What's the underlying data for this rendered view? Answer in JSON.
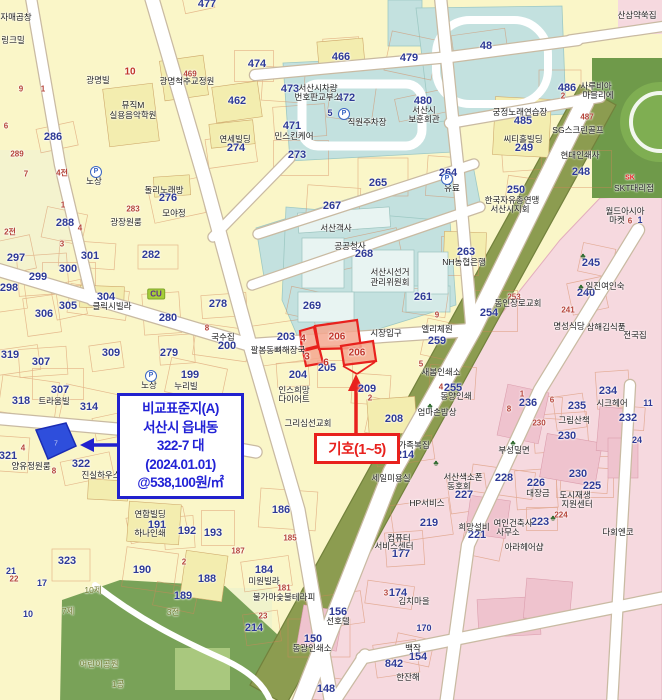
{
  "annotation": {
    "lines": [
      "비교표준지(A)",
      "서산시 읍내동",
      "322-7  대",
      "(2024.01.01)",
      "@538,100원/㎡"
    ],
    "border_color": "#2121CE",
    "text_color": "#2222D6"
  },
  "marker": {
    "label": "기호(1~5)",
    "color": "#E8211D"
  },
  "highlight": {
    "blue_parcel_no": "7",
    "blue_fill": "#2E4EDC",
    "red_fill": "#F5A78F",
    "red_stroke": "#E8211D"
  },
  "colors": {
    "base": "#FAF6C8",
    "civic": "#C3E1DF",
    "commercial": "#F6D9DF",
    "greenbelt": "#8C9C50",
    "park": "#79A258",
    "road": "#FFFFFF"
  },
  "labels": [
    {
      "t": "477",
      "x": 207,
      "y": 4,
      "c": "pn"
    },
    {
      "t": "462",
      "x": 237,
      "y": 101,
      "c": "pn"
    },
    {
      "t": "466",
      "x": 341,
      "y": 57,
      "c": "pn"
    },
    {
      "t": "474",
      "x": 257,
      "y": 64,
      "c": "pn"
    },
    {
      "t": "473",
      "x": 290,
      "y": 89,
      "c": "pn"
    },
    {
      "t": "472",
      "x": 346,
      "y": 98,
      "c": "pn"
    },
    {
      "t": "479",
      "x": 409,
      "y": 58,
      "c": "pn"
    },
    {
      "t": "480",
      "x": 423,
      "y": 101,
      "c": "pn"
    },
    {
      "t": "48",
      "x": 486,
      "y": 46,
      "c": "pn"
    },
    {
      "t": "10",
      "x": 130,
      "y": 72,
      "c": "rsb"
    },
    {
      "t": "9",
      "x": 21,
      "y": 89,
      "c": "rs"
    },
    {
      "t": "1",
      "x": 43,
      "y": 89,
      "c": "rs"
    },
    {
      "t": "6",
      "x": 6,
      "y": 126,
      "c": "rs"
    },
    {
      "t": "289",
      "x": 17,
      "y": 154,
      "c": "rs"
    },
    {
      "t": "286",
      "x": 53,
      "y": 137,
      "c": "pn"
    },
    {
      "t": "광명빌",
      "x": 98,
      "y": 80,
      "c": "nm"
    },
    {
      "t": "자매곱창",
      "x": 16,
      "y": 17,
      "c": "nm"
    },
    {
      "t": "링크밀",
      "x": 13,
      "y": 40,
      "c": "nm"
    },
    {
      "t": "뮤직M",
      "x": 133,
      "y": 105,
      "c": "nm"
    },
    {
      "t": "실용음악학원",
      "x": 133,
      "y": 115,
      "c": "nm"
    },
    {
      "t": "광명척추교정원",
      "x": 187,
      "y": 81,
      "c": "nm"
    },
    {
      "t": "469",
      "x": 190,
      "y": 74,
      "c": "rs"
    },
    {
      "t": "서산시차량",
      "x": 318,
      "y": 88,
      "c": "nm"
    },
    {
      "t": "번호판교부소",
      "x": 318,
      "y": 97,
      "c": "nm"
    },
    {
      "t": "직원주차장",
      "x": 367,
      "y": 122,
      "c": "nm"
    },
    {
      "t": "5",
      "x": 330,
      "y": 113,
      "c": "pn2"
    },
    {
      "t": "P",
      "x": 344,
      "y": 114,
      "c": "icp"
    },
    {
      "t": "민스킨케어",
      "x": 294,
      "y": 136,
      "c": "nm"
    },
    {
      "t": "연세빌딩",
      "x": 235,
      "y": 139,
      "c": "nm"
    },
    {
      "t": "274",
      "x": 236,
      "y": 148,
      "c": "pn"
    },
    {
      "t": "471",
      "x": 292,
      "y": 126,
      "c": "pn"
    },
    {
      "t": "273",
      "x": 297,
      "y": 155,
      "c": "pn"
    },
    {
      "t": "서산시",
      "x": 424,
      "y": 110,
      "c": "nm"
    },
    {
      "t": "보훈회관",
      "x": 424,
      "y": 119,
      "c": "nm"
    },
    {
      "t": "궁정노래연습장",
      "x": 520,
      "y": 112,
      "c": "nm"
    },
    {
      "t": "485",
      "x": 523,
      "y": 121,
      "c": "pn"
    },
    {
      "t": "씨티홀빌딩",
      "x": 523,
      "y": 139,
      "c": "nm"
    },
    {
      "t": "249",
      "x": 524,
      "y": 148,
      "c": "pn"
    },
    {
      "t": "486",
      "x": 567,
      "y": 88,
      "c": "pn"
    },
    {
      "t": "2",
      "x": 563,
      "y": 96,
      "c": "rs"
    },
    {
      "t": "사루비아",
      "x": 596,
      "y": 86,
      "c": "nm"
    },
    {
      "t": "마블리에",
      "x": 598,
      "y": 95,
      "c": "nm"
    },
    {
      "t": "487",
      "x": 587,
      "y": 117,
      "c": "rs"
    },
    {
      "t": "SG스크린골프",
      "x": 578,
      "y": 130,
      "c": "nm"
    },
    {
      "t": "현대인쇄사",
      "x": 580,
      "y": 155,
      "c": "nm"
    },
    {
      "t": "248",
      "x": 581,
      "y": 172,
      "c": "pn"
    },
    {
      "t": "264",
      "x": 448,
      "y": 173,
      "c": "pn"
    },
    {
      "t": "250",
      "x": 516,
      "y": 190,
      "c": "pn"
    },
    {
      "t": "한국자유총연맹",
      "x": 512,
      "y": 200,
      "c": "nm"
    },
    {
      "t": "서산시지회",
      "x": 510,
      "y": 209,
      "c": "nm"
    },
    {
      "t": "유료",
      "x": 452,
      "y": 188,
      "c": "nm"
    },
    {
      "t": "P",
      "x": 447,
      "y": 179,
      "c": "icp"
    },
    {
      "t": "265",
      "x": 378,
      "y": 183,
      "c": "pn"
    },
    {
      "t": "267",
      "x": 332,
      "y": 206,
      "c": "pn"
    },
    {
      "t": "서산객사",
      "x": 336,
      "y": 228,
      "c": "nm"
    },
    {
      "t": "공공청사",
      "x": 350,
      "y": 246,
      "c": "nm"
    },
    {
      "t": "268",
      "x": 364,
      "y": 254,
      "c": "pn"
    },
    {
      "t": "서산시선거",
      "x": 390,
      "y": 272,
      "c": "nm"
    },
    {
      "t": "관리위원회",
      "x": 390,
      "y": 282,
      "c": "nm"
    },
    {
      "t": "263",
      "x": 466,
      "y": 252,
      "c": "pn"
    },
    {
      "t": "NH농협은행",
      "x": 464,
      "y": 262,
      "c": "nm"
    },
    {
      "t": "261",
      "x": 423,
      "y": 297,
      "c": "pn"
    },
    {
      "t": "269",
      "x": 312,
      "y": 306,
      "c": "pn"
    },
    {
      "t": "SK",
      "x": 630,
      "y": 178,
      "c": "sk"
    },
    {
      "t": "SKT대리점",
      "x": 634,
      "y": 188,
      "c": "nm"
    },
    {
      "t": "월드아시아",
      "x": 625,
      "y": 211,
      "c": "nm"
    },
    {
      "t": "마켓",
      "x": 617,
      "y": 220,
      "c": "nm"
    },
    {
      "t": "6",
      "x": 630,
      "y": 221,
      "c": "rs"
    },
    {
      "t": "1",
      "x": 640,
      "y": 220,
      "c": "pn2"
    },
    {
      "t": "245",
      "x": 591,
      "y": 263,
      "c": "pn"
    },
    {
      "t": "240",
      "x": 586,
      "y": 293,
      "c": "pn"
    },
    {
      "t": "일진여인숙",
      "x": 605,
      "y": 286,
      "c": "nm"
    },
    {
      "t": "253",
      "x": 514,
      "y": 297,
      "c": "rs"
    },
    {
      "t": "254",
      "x": 489,
      "y": 313,
      "c": "pn"
    },
    {
      "t": "동인장로교회",
      "x": 518,
      "y": 303,
      "c": "nm"
    },
    {
      "t": "명성식당",
      "x": 569,
      "y": 326,
      "c": "nm"
    },
    {
      "t": "삼해김식품",
      "x": 606,
      "y": 327,
      "c": "nm"
    },
    {
      "t": "전국집",
      "x": 635,
      "y": 335,
      "c": "nm"
    },
    {
      "t": "241",
      "x": 568,
      "y": 310,
      "c": "rs"
    },
    {
      "t": "노상",
      "x": 94,
      "y": 181,
      "c": "nm"
    },
    {
      "t": "P",
      "x": 96,
      "y": 172,
      "c": "icp"
    },
    {
      "t": "노상",
      "x": 149,
      "y": 385,
      "c": "nm"
    },
    {
      "t": "P",
      "x": 151,
      "y": 376,
      "c": "icp"
    },
    {
      "t": "288",
      "x": 65,
      "y": 223,
      "c": "pn"
    },
    {
      "t": "297",
      "x": 16,
      "y": 258,
      "c": "pn"
    },
    {
      "t": "298",
      "x": 9,
      "y": 288,
      "c": "pn"
    },
    {
      "t": "299",
      "x": 38,
      "y": 277,
      "c": "pn"
    },
    {
      "t": "300",
      "x": 68,
      "y": 269,
      "c": "pn"
    },
    {
      "t": "301",
      "x": 90,
      "y": 256,
      "c": "pn"
    },
    {
      "t": "304",
      "x": 106,
      "y": 297,
      "c": "pn"
    },
    {
      "t": "클릭시빌라",
      "x": 112,
      "y": 306,
      "c": "nm"
    },
    {
      "t": "305",
      "x": 68,
      "y": 306,
      "c": "pn"
    },
    {
      "t": "306",
      "x": 44,
      "y": 314,
      "c": "pn"
    },
    {
      "t": "280",
      "x": 168,
      "y": 318,
      "c": "pn"
    },
    {
      "t": "282",
      "x": 151,
      "y": 255,
      "c": "pn"
    },
    {
      "t": "283",
      "x": 133,
      "y": 209,
      "c": "rs"
    },
    {
      "t": "광장원룸",
      "x": 126,
      "y": 222,
      "c": "nm"
    },
    {
      "t": "돌리노래방",
      "x": 164,
      "y": 190,
      "c": "nm"
    },
    {
      "t": "276",
      "x": 168,
      "y": 198,
      "c": "pn"
    },
    {
      "t": "모야정",
      "x": 174,
      "y": 213,
      "c": "nm"
    },
    {
      "t": "CU",
      "x": 156,
      "y": 294,
      "c": "cu"
    },
    {
      "t": "4전",
      "x": 62,
      "y": 173,
      "c": "rs"
    },
    {
      "t": "7",
      "x": 26,
      "y": 174,
      "c": "rs"
    },
    {
      "t": "2전",
      "x": 10,
      "y": 232,
      "c": "rs"
    },
    {
      "t": "3",
      "x": 62,
      "y": 244,
      "c": "rs"
    },
    {
      "t": "4",
      "x": 80,
      "y": 228,
      "c": "rs"
    },
    {
      "t": "1",
      "x": 63,
      "y": 205,
      "c": "rs"
    },
    {
      "t": "278",
      "x": 218,
      "y": 304,
      "c": "pn"
    },
    {
      "t": "8",
      "x": 207,
      "y": 328,
      "c": "rs"
    },
    {
      "t": "국수집",
      "x": 223,
      "y": 337,
      "c": "nm"
    },
    {
      "t": "200",
      "x": 227,
      "y": 346,
      "c": "pn"
    },
    {
      "t": "199",
      "x": 190,
      "y": 375,
      "c": "pn"
    },
    {
      "t": "누리빌",
      "x": 186,
      "y": 386,
      "c": "nm"
    },
    {
      "t": "203",
      "x": 286,
      "y": 337,
      "c": "pn"
    },
    {
      "t": "204",
      "x": 298,
      "y": 375,
      "c": "pn"
    },
    {
      "t": "205",
      "x": 327,
      "y": 368,
      "c": "pn"
    },
    {
      "t": "209",
      "x": 367,
      "y": 389,
      "c": "pn"
    },
    {
      "t": "2",
      "x": 370,
      "y": 398,
      "c": "rs"
    },
    {
      "t": "208",
      "x": 394,
      "y": 419,
      "c": "pn"
    },
    {
      "t": "팔봉동뼈해장국",
      "x": 278,
      "y": 350,
      "c": "nm"
    },
    {
      "t": "인스희망",
      "x": 294,
      "y": 390,
      "c": "nm"
    },
    {
      "t": "다이어트",
      "x": 294,
      "y": 399,
      "c": "nm"
    },
    {
      "t": "그리심선교회",
      "x": 308,
      "y": 423,
      "c": "nm"
    },
    {
      "t": "시장입구",
      "x": 386,
      "y": 333,
      "c": "nm"
    },
    {
      "t": "엘리체원",
      "x": 437,
      "y": 329,
      "c": "nm"
    },
    {
      "t": "259",
      "x": 437,
      "y": 341,
      "c": "pn"
    },
    {
      "t": "9",
      "x": 437,
      "y": 315,
      "c": "rs"
    },
    {
      "t": "5",
      "x": 421,
      "y": 364,
      "c": "rs"
    },
    {
      "t": "새봄인쇄소",
      "x": 441,
      "y": 372,
      "c": "nm"
    },
    {
      "t": "4",
      "x": 441,
      "y": 387,
      "c": "rs"
    },
    {
      "t": "255",
      "x": 453,
      "y": 388,
      "c": "pn"
    },
    {
      "t": "동양인쇄",
      "x": 456,
      "y": 396,
      "c": "nm"
    },
    {
      "t": "엄마손밥상",
      "x": 437,
      "y": 412,
      "c": "nm"
    },
    {
      "t": "가족복집",
      "x": 414,
      "y": 445,
      "c": "nm"
    },
    {
      "t": "214",
      "x": 405,
      "y": 455,
      "c": "pn"
    },
    {
      "t": "세일미용실",
      "x": 391,
      "y": 478,
      "c": "nm"
    },
    {
      "t": "4",
      "x": 303,
      "y": 339,
      "c": "rsb"
    },
    {
      "t": "3",
      "x": 307,
      "y": 357,
      "c": "rsb"
    },
    {
      "t": "206",
      "x": 337,
      "y": 337,
      "c": "rsb"
    },
    {
      "t": "206",
      "x": 357,
      "y": 353,
      "c": "rsb"
    },
    {
      "t": "6",
      "x": 326,
      "y": 363,
      "c": "rsb"
    },
    {
      "t": "319",
      "x": 10,
      "y": 355,
      "c": "pn"
    },
    {
      "t": "307",
      "x": 41,
      "y": 362,
      "c": "pn"
    },
    {
      "t": "307",
      "x": 60,
      "y": 390,
      "c": "pn"
    },
    {
      "t": "트라움빌",
      "x": 54,
      "y": 401,
      "c": "nm"
    },
    {
      "t": "318",
      "x": 21,
      "y": 401,
      "c": "pn"
    },
    {
      "t": "314",
      "x": 89,
      "y": 407,
      "c": "pn"
    },
    {
      "t": "313",
      "x": 127,
      "y": 427,
      "c": "pn"
    },
    {
      "t": "309",
      "x": 111,
      "y": 353,
      "c": "pn"
    },
    {
      "t": "279",
      "x": 169,
      "y": 353,
      "c": "pn"
    },
    {
      "t": "323",
      "x": 67,
      "y": 561,
      "c": "pn"
    },
    {
      "t": "321",
      "x": 8,
      "y": 456,
      "c": "pn"
    },
    {
      "t": "양유정원룸",
      "x": 31,
      "y": 466,
      "c": "nm"
    },
    {
      "t": "4",
      "x": 23,
      "y": 448,
      "c": "rs"
    },
    {
      "t": "322",
      "x": 81,
      "y": 464,
      "c": "pn"
    },
    {
      "t": "8",
      "x": 54,
      "y": 471,
      "c": "rs"
    },
    {
      "t": "진실하우스",
      "x": 101,
      "y": 475,
      "c": "nm"
    },
    {
      "t": "21",
      "x": 11,
      "y": 571,
      "c": "pn2"
    },
    {
      "t": "22",
      "x": 14,
      "y": 579,
      "c": "rs"
    },
    {
      "t": "17",
      "x": 42,
      "y": 583,
      "c": "pn2"
    },
    {
      "t": "10",
      "x": 28,
      "y": 614,
      "c": "pn2"
    },
    {
      "t": "7제",
      "x": 68,
      "y": 611,
      "c": "gn"
    },
    {
      "t": "10제",
      "x": 93,
      "y": 590,
      "c": "gn"
    },
    {
      "t": "어린이공원",
      "x": 99,
      "y": 664,
      "c": "gn"
    },
    {
      "t": "1공",
      "x": 118,
      "y": 684,
      "c": "gn"
    },
    {
      "t": "3전",
      "x": 173,
      "y": 612,
      "c": "gn"
    },
    {
      "t": "190",
      "x": 142,
      "y": 570,
      "c": "pn"
    },
    {
      "t": "연합빌딩",
      "x": 150,
      "y": 514,
      "c": "nm"
    },
    {
      "t": "191",
      "x": 157,
      "y": 525,
      "c": "pn"
    },
    {
      "t": "하나인쇄",
      "x": 150,
      "y": 533,
      "c": "nm"
    },
    {
      "t": "192",
      "x": 187,
      "y": 531,
      "c": "pn"
    },
    {
      "t": "193",
      "x": 213,
      "y": 533,
      "c": "pn"
    },
    {
      "t": "2",
      "x": 184,
      "y": 562,
      "c": "rs"
    },
    {
      "t": "188",
      "x": 207,
      "y": 579,
      "c": "pn"
    },
    {
      "t": "189",
      "x": 183,
      "y": 596,
      "c": "pn"
    },
    {
      "t": "187",
      "x": 238,
      "y": 551,
      "c": "rs"
    },
    {
      "t": "184",
      "x": 264,
      "y": 570,
      "c": "pn"
    },
    {
      "t": "미원빌라",
      "x": 264,
      "y": 581,
      "c": "nm"
    },
    {
      "t": "185",
      "x": 290,
      "y": 538,
      "c": "rs"
    },
    {
      "t": "186",
      "x": 281,
      "y": 510,
      "c": "pn"
    },
    {
      "t": "181",
      "x": 284,
      "y": 588,
      "c": "rs"
    },
    {
      "t": "불가마숯불테라피",
      "x": 284,
      "y": 597,
      "c": "nm"
    },
    {
      "t": "23",
      "x": 263,
      "y": 616,
      "c": "rs"
    },
    {
      "t": "214",
      "x": 254,
      "y": 628,
      "c": "pn"
    },
    {
      "t": "177",
      "x": 401,
      "y": 554,
      "c": "pn"
    },
    {
      "t": "컴퓨터",
      "x": 399,
      "y": 538,
      "c": "nm"
    },
    {
      "t": "서비스센터",
      "x": 394,
      "y": 546,
      "c": "nm"
    },
    {
      "t": "174",
      "x": 398,
      "y": 593,
      "c": "pn"
    },
    {
      "t": "3",
      "x": 386,
      "y": 593,
      "c": "rs"
    },
    {
      "t": "김치마을",
      "x": 414,
      "y": 601,
      "c": "nm"
    },
    {
      "t": "156",
      "x": 338,
      "y": 612,
      "c": "pn"
    },
    {
      "t": "선호텔",
      "x": 338,
      "y": 621,
      "c": "nm"
    },
    {
      "t": "150",
      "x": 313,
      "y": 639,
      "c": "pn"
    },
    {
      "t": "동광인쇄소",
      "x": 312,
      "y": 648,
      "c": "nm"
    },
    {
      "t": "148",
      "x": 326,
      "y": 689,
      "c": "pn"
    },
    {
      "t": "154",
      "x": 418,
      "y": 657,
      "c": "pn"
    },
    {
      "t": "백작",
      "x": 413,
      "y": 648,
      "c": "nm"
    },
    {
      "t": "842",
      "x": 394,
      "y": 664,
      "c": "pn"
    },
    {
      "t": "170",
      "x": 424,
      "y": 628,
      "c": "pn2"
    },
    {
      "t": "한잔해",
      "x": 408,
      "y": 677,
      "c": "nm"
    },
    {
      "t": "236",
      "x": 528,
      "y": 403,
      "c": "pn"
    },
    {
      "t": "1",
      "x": 522,
      "y": 394,
      "c": "rs"
    },
    {
      "t": "8",
      "x": 509,
      "y": 409,
      "c": "rs"
    },
    {
      "t": "6",
      "x": 552,
      "y": 400,
      "c": "rs"
    },
    {
      "t": "235",
      "x": 577,
      "y": 406,
      "c": "pn"
    },
    {
      "t": "234",
      "x": 608,
      "y": 391,
      "c": "pn"
    },
    {
      "t": "시크헤어",
      "x": 612,
      "y": 403,
      "c": "nm"
    },
    {
      "t": "232",
      "x": 628,
      "y": 418,
      "c": "pn"
    },
    {
      "t": "24",
      "x": 637,
      "y": 440,
      "c": "pn2"
    },
    {
      "t": "11",
      "x": 648,
      "y": 403,
      "c": "pn2"
    },
    {
      "t": "그림산책",
      "x": 574,
      "y": 420,
      "c": "nm"
    },
    {
      "t": "230",
      "x": 539,
      "y": 423,
      "c": "rs"
    },
    {
      "t": "230",
      "x": 567,
      "y": 436,
      "c": "pn"
    },
    {
      "t": "230",
      "x": 578,
      "y": 474,
      "c": "pn"
    },
    {
      "t": "부성밀면",
      "x": 514,
      "y": 450,
      "c": "nm"
    },
    {
      "t": "228",
      "x": 504,
      "y": 478,
      "c": "pn"
    },
    {
      "t": "서산색소폰",
      "x": 463,
      "y": 477,
      "c": "nm"
    },
    {
      "t": "동호회",
      "x": 459,
      "y": 486,
      "c": "nm"
    },
    {
      "t": "227",
      "x": 464,
      "y": 495,
      "c": "pn"
    },
    {
      "t": "226",
      "x": 536,
      "y": 483,
      "c": "pn"
    },
    {
      "t": "대장금",
      "x": 538,
      "y": 493,
      "c": "nm"
    },
    {
      "t": "225",
      "x": 592,
      "y": 486,
      "c": "pn"
    },
    {
      "t": "도시재생",
      "x": 575,
      "y": 495,
      "c": "nm"
    },
    {
      "t": "지원센터",
      "x": 577,
      "y": 504,
      "c": "nm"
    },
    {
      "t": "HP서비스",
      "x": 427,
      "y": 503,
      "c": "nm"
    },
    {
      "t": "219",
      "x": 429,
      "y": 523,
      "c": "pn"
    },
    {
      "t": "224",
      "x": 561,
      "y": 515,
      "c": "rs"
    },
    {
      "t": "223",
      "x": 540,
      "y": 522,
      "c": "pn"
    },
    {
      "t": "여인건축사",
      "x": 513,
      "y": 523,
      "c": "nm"
    },
    {
      "t": "사무소",
      "x": 508,
      "y": 532,
      "c": "nm"
    },
    {
      "t": "221",
      "x": 477,
      "y": 535,
      "c": "pn"
    },
    {
      "t": "희망설비",
      "x": 474,
      "y": 527,
      "c": "nm"
    },
    {
      "t": "아라헤어샵",
      "x": 524,
      "y": 547,
      "c": "nm"
    },
    {
      "t": "다회엔코",
      "x": 618,
      "y": 532,
      "c": "nm"
    },
    {
      "t": "산삼약쑥집",
      "x": 637,
      "y": 15,
      "c": "nm"
    },
    {
      "t": "♣",
      "x": 583,
      "y": 256,
      "c": "tr"
    },
    {
      "t": "♣",
      "x": 581,
      "y": 287,
      "c": "tr"
    },
    {
      "t": "♣",
      "x": 430,
      "y": 406,
      "c": "tr"
    },
    {
      "t": "♣",
      "x": 553,
      "y": 518,
      "c": "tr"
    },
    {
      "t": "♣",
      "x": 513,
      "y": 443,
      "c": "tr"
    },
    {
      "t": "♣",
      "x": 436,
      "y": 463,
      "c": "tr"
    }
  ]
}
